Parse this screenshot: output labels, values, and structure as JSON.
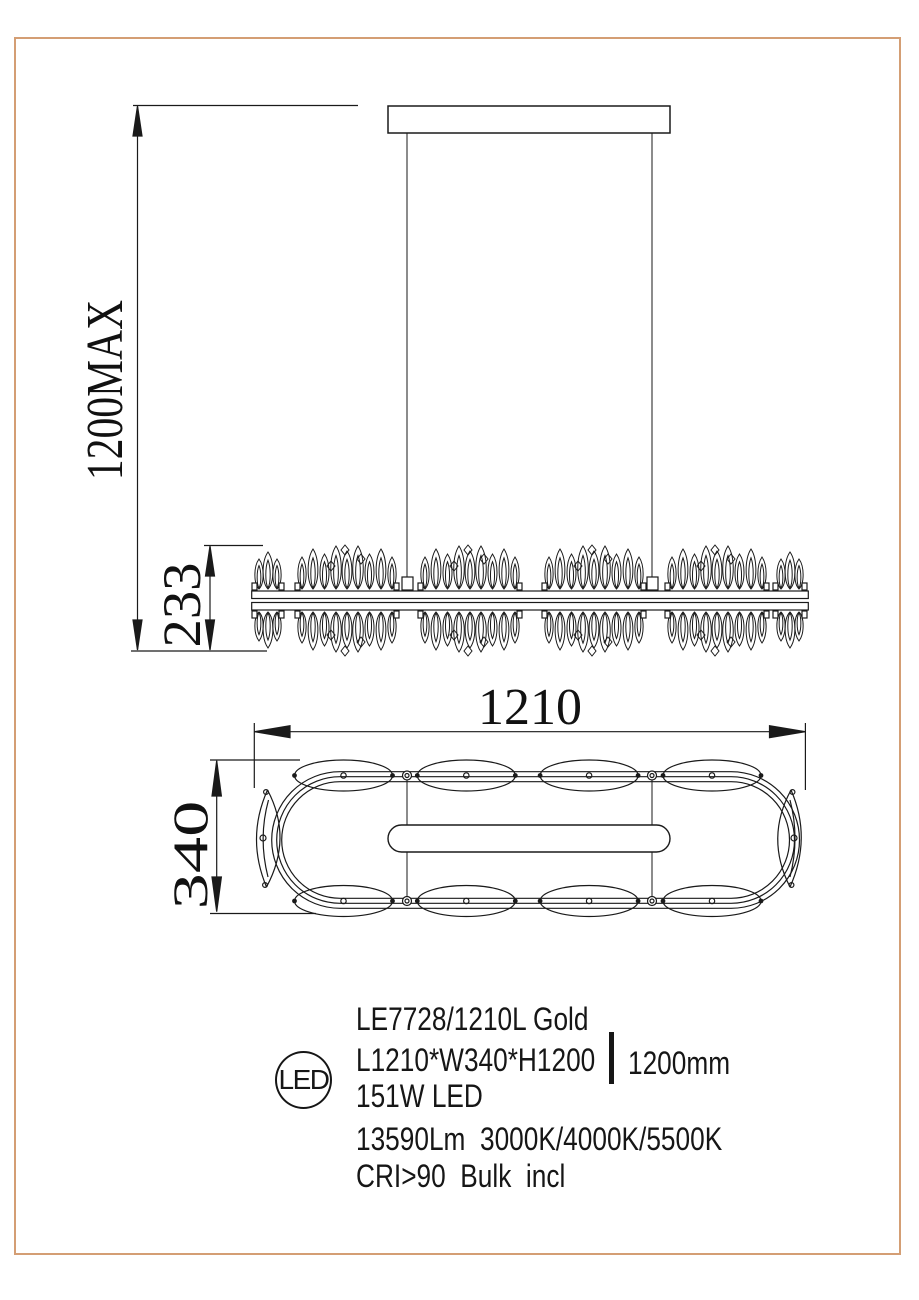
{
  "frame": {
    "border_color": "#d49e74"
  },
  "front_view": {
    "height_max_label": "1200MAX",
    "fixture_height_label": "233"
  },
  "top_view": {
    "length_label": "1210",
    "width_label": "340"
  },
  "specs": {
    "led_badge": "LED",
    "model": "LE7728/1210L Gold",
    "dimensions": "L1210*W340*H1200",
    "suspension_height": "1200mm",
    "wattage": "151W LED",
    "lumens_color_temp": "13590Lm  3000K/4000K/5500K",
    "cri_bulb": "CRI>90  Bulk  incl"
  }
}
